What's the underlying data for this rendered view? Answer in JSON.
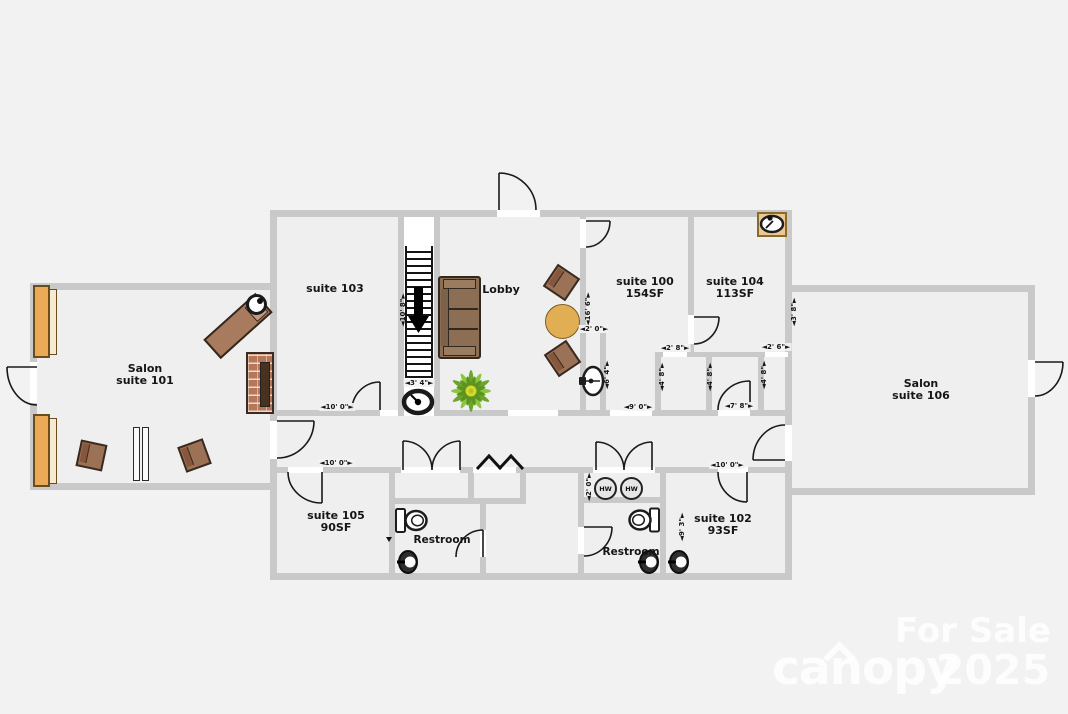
{
  "rooms": {
    "salon101": {
      "l1": "Salon",
      "l2": "suite 101"
    },
    "suite103": {
      "l1": "suite 103"
    },
    "lobby": {
      "l1": "Lobby"
    },
    "suite100": {
      "l1": "suite 100",
      "l2": "154SF"
    },
    "suite104": {
      "l1": "suite 104",
      "l2": "113SF"
    },
    "salon106": {
      "l1": "Salon",
      "l2": "suite 106"
    },
    "suite105": {
      "l1": "suite 105",
      "l2": "90SF"
    },
    "suite102": {
      "l1": "suite 102",
      "l2": "93SF"
    },
    "restroom_w": {
      "l1": "Restroom"
    },
    "restroom_e": {
      "l1": "Restroom"
    }
  },
  "dims": {
    "stairs_h": "◄10' 8\"►",
    "stairs_w": "◄3' 4\"►",
    "s103_opening": "◄10' 0\"►",
    "s100_wall": "◄16' 6\"►",
    "nook_w": "◄2' 0\"►",
    "nook_h": "◄6' 4\"►",
    "closet_a_w": "◄2' 8\"►",
    "closet_a_hl": "◄4' 8\"►",
    "closet_a_hr": "◄4' 8\"►",
    "hall_opening": "◄9' 0\"►",
    "closet_b_w": "◄2' 6\"►",
    "closet_b_h": "◄4' 8\"►",
    "door_78": "◄7' 8\"►",
    "s106_wall": "◄3' 8\"►",
    "s105_wall": "◄10' 0\"►",
    "s102_wall": "◄10' 0\"►",
    "hw_niche": "◄2' 0\"►",
    "s102_side": "◄9' 3\"►"
  },
  "equipment": {
    "water_heater": "HW"
  },
  "watermark": {
    "sale": "For Sale",
    "brand": "canopy",
    "year": "2025"
  },
  "colors": {
    "wall": "#c9c9c9",
    "floor": "#efefef",
    "background": "#f2f2f2",
    "furniture_wood": "#a87a5e",
    "cabinet_tan": "#eaaa56",
    "plant_green": "#7fb43a"
  }
}
